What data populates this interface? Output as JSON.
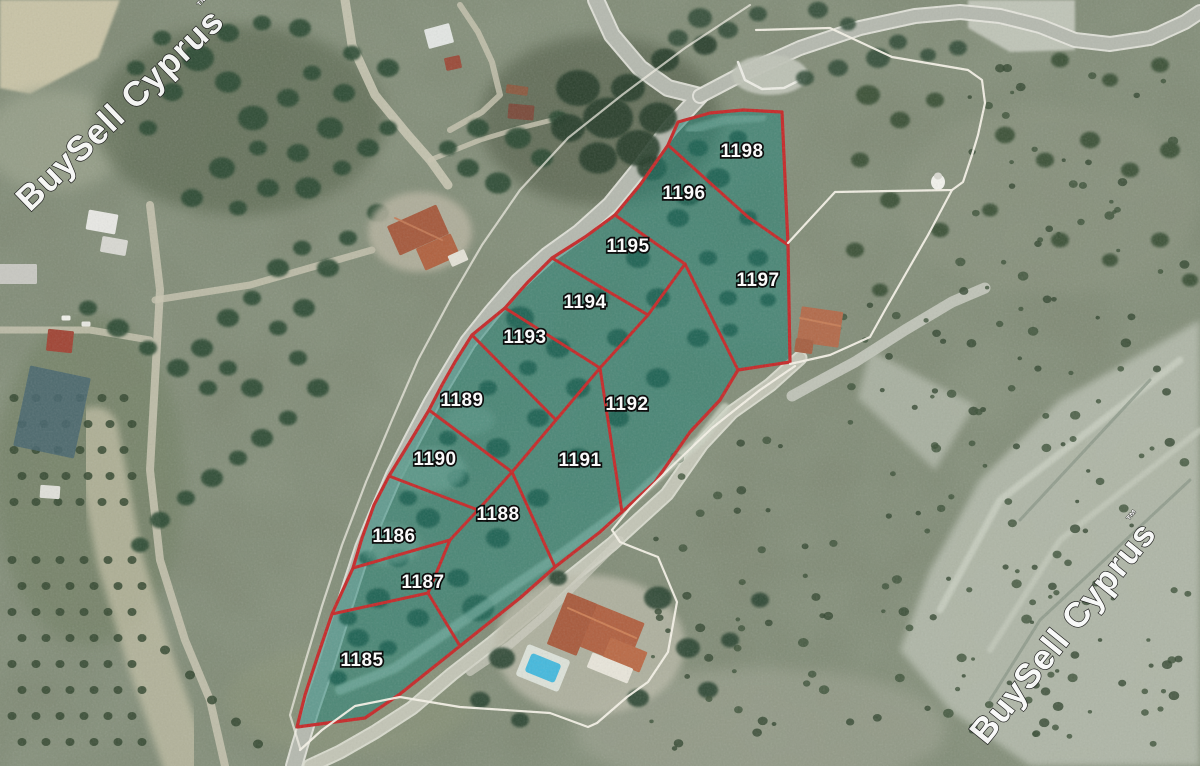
{
  "map": {
    "title": "Satellite land-parcel map",
    "watermark": {
      "text": "BuySell Cyprus",
      "tm": "™",
      "fill": "#ffffff",
      "outline": "#141414"
    },
    "colors": {
      "parcel_overlay": "#1a8a7c",
      "parcel_overlay_opacity": 0.45,
      "parcel_boundary": "#c62828",
      "neighbor_boundary": "#f5f2e8",
      "label_fill": "#ffffff",
      "label_outline": "#000000"
    },
    "parcels": [
      {
        "number": "1185",
        "label": {
          "x": 362,
          "y": 666
        }
      },
      {
        "number": "1186",
        "label": {
          "x": 394,
          "y": 542
        }
      },
      {
        "number": "1187",
        "label": {
          "x": 423,
          "y": 588
        }
      },
      {
        "number": "1188",
        "label": {
          "x": 498,
          "y": 520
        }
      },
      {
        "number": "1189",
        "label": {
          "x": 462,
          "y": 406
        }
      },
      {
        "number": "1190",
        "label": {
          "x": 435,
          "y": 465
        }
      },
      {
        "number": "1191",
        "label": {
          "x": 580,
          "y": 466
        }
      },
      {
        "number": "1192",
        "label": {
          "x": 627,
          "y": 410
        }
      },
      {
        "number": "1193",
        "label": {
          "x": 525,
          "y": 343
        }
      },
      {
        "number": "1194",
        "label": {
          "x": 585,
          "y": 308
        }
      },
      {
        "number": "1195",
        "label": {
          "x": 628,
          "y": 252
        }
      },
      {
        "number": "1196",
        "label": {
          "x": 684,
          "y": 199
        }
      },
      {
        "number": "1197",
        "label": {
          "x": 758,
          "y": 286
        }
      },
      {
        "number": "1198",
        "label": {
          "x": 742,
          "y": 157
        }
      }
    ],
    "boundaries": {
      "outer": [
        [
          678,
          122
        ],
        [
          668,
          145
        ],
        [
          640,
          185
        ],
        [
          615,
          215
        ],
        [
          585,
          237
        ],
        [
          552,
          258
        ],
        [
          527,
          283
        ],
        [
          505,
          308
        ],
        [
          472,
          335
        ],
        [
          455,
          362
        ],
        [
          442,
          385
        ],
        [
          429,
          410
        ],
        [
          408,
          445
        ],
        [
          389,
          476
        ],
        [
          374,
          505
        ],
        [
          362,
          538
        ],
        [
          353,
          568
        ],
        [
          342,
          592
        ],
        [
          332,
          614
        ],
        [
          318,
          655
        ],
        [
          305,
          695
        ],
        [
          297,
          727
        ],
        [
          365,
          718
        ],
        [
          400,
          694
        ],
        [
          440,
          662
        ],
        [
          460,
          646
        ],
        [
          480,
          630
        ],
        [
          520,
          598
        ],
        [
          555,
          567
        ],
        [
          600,
          532
        ],
        [
          622,
          512
        ],
        [
          655,
          482
        ],
        [
          690,
          432
        ],
        [
          720,
          400
        ],
        [
          738,
          370
        ],
        [
          790,
          362
        ],
        [
          788,
          245
        ],
        [
          782,
          112
        ],
        [
          743,
          110
        ],
        [
          710,
          113
        ],
        [
          678,
          122
        ]
      ],
      "internal": [
        [
          [
            668,
            145
          ],
          [
            748,
            217
          ],
          [
            788,
            245
          ]
        ],
        [
          [
            615,
            215
          ],
          [
            685,
            264
          ]
        ],
        [
          [
            685,
            264
          ],
          [
            738,
            370
          ]
        ],
        [
          [
            685,
            264
          ],
          [
            648,
            315
          ],
          [
            600,
            368
          ],
          [
            556,
            420
          ],
          [
            512,
            472
          ],
          [
            478,
            510
          ],
          [
            450,
            540
          ],
          [
            428,
            593
          ]
        ],
        [
          [
            552,
            258
          ],
          [
            648,
            315
          ]
        ],
        [
          [
            505,
            308
          ],
          [
            600,
            368
          ]
        ],
        [
          [
            472,
            335
          ],
          [
            556,
            420
          ]
        ],
        [
          [
            429,
            410
          ],
          [
            512,
            472
          ]
        ],
        [
          [
            389,
            476
          ],
          [
            478,
            510
          ]
        ],
        [
          [
            353,
            568
          ],
          [
            450,
            540
          ]
        ],
        [
          [
            332,
            614
          ],
          [
            428,
            593
          ]
        ],
        [
          [
            600,
            368
          ],
          [
            622,
            512
          ]
        ],
        [
          [
            512,
            472
          ],
          [
            555,
            567
          ]
        ],
        [
          [
            428,
            593
          ],
          [
            460,
            646
          ]
        ]
      ],
      "neighbor": [
        [
          [
            756,
            30
          ],
          [
            830,
            28
          ],
          [
            892,
            57
          ],
          [
            968,
            70
          ],
          [
            982,
            80
          ],
          [
            985,
            103
          ],
          [
            978,
            135
          ],
          [
            972,
            155
          ],
          [
            963,
            182
          ],
          [
            952,
            190
          ],
          [
            890,
            191
          ],
          [
            835,
            192
          ],
          [
            788,
            243
          ]
        ],
        [
          [
            952,
            190
          ],
          [
            928,
            235
          ],
          [
            905,
            275
          ],
          [
            885,
            310
          ],
          [
            870,
            337
          ],
          [
            830,
            355
          ],
          [
            790,
            364
          ]
        ],
        [
          [
            795,
            366
          ],
          [
            760,
            390
          ],
          [
            712,
            428
          ],
          [
            668,
            470
          ],
          [
            630,
            508
          ],
          [
            612,
            530
          ],
          [
            620,
            542
          ],
          [
            640,
            550
          ],
          [
            658,
            557
          ],
          [
            677,
            602
          ],
          [
            668,
            652
          ],
          [
            648,
            682
          ],
          [
            627,
            697
          ],
          [
            597,
            723
          ],
          [
            588,
            727
          ],
          [
            550,
            713
          ],
          [
            460,
            707
          ],
          [
            400,
            697
          ],
          [
            355,
            706
          ],
          [
            322,
            730
          ],
          [
            300,
            750
          ]
        ],
        [
          [
            750,
            5
          ],
          [
            685,
            48
          ],
          [
            622,
            95
          ],
          [
            568,
            138
          ],
          [
            520,
            190
          ],
          [
            482,
            245
          ],
          [
            450,
            300
          ],
          [
            418,
            360
          ],
          [
            392,
            420
          ],
          [
            366,
            482
          ],
          [
            342,
            545
          ],
          [
            322,
            606
          ],
          [
            304,
            666
          ],
          [
            290,
            715
          ],
          [
            300,
            748
          ]
        ]
      ]
    },
    "watermark_placements": [
      {
        "x": 128,
        "y": 118,
        "angle": -44
      },
      {
        "x": 1072,
        "y": 640,
        "angle": -51
      }
    ]
  }
}
